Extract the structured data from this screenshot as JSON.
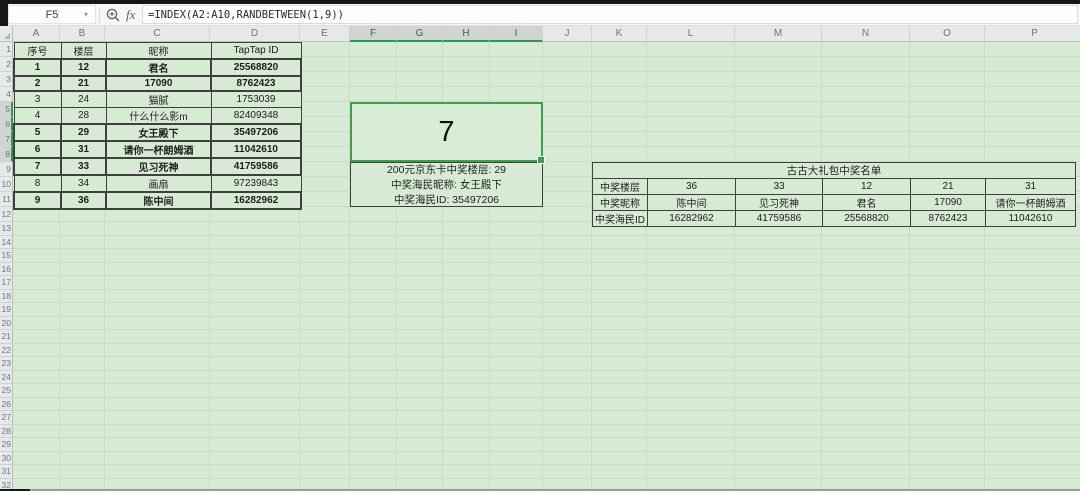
{
  "app": {
    "formula_bar": {
      "name_box": "F5",
      "fx_label": "fx",
      "formula": "=INDEX(A2:A10,RANDBETWEEN(1,9))"
    }
  },
  "grid": {
    "column_letters": [
      "A",
      "B",
      "C",
      "D",
      "E",
      "F",
      "G",
      "H",
      "I",
      "J",
      "K",
      "L",
      "M",
      "N",
      "O",
      "P"
    ],
    "selected_columns": [
      "F",
      "G",
      "H",
      "I"
    ],
    "row_count": 32,
    "selected_rows": [
      5,
      6,
      7,
      8
    ]
  },
  "left_table": {
    "headers": [
      "序号",
      "楼层",
      "昵称",
      "TapTap ID"
    ],
    "rows": [
      {
        "cells": [
          "1",
          "12",
          "君名",
          "25568820"
        ],
        "bold": true
      },
      {
        "cells": [
          "2",
          "21",
          "17090",
          "8762423"
        ],
        "bold": true
      },
      {
        "cells": [
          "3",
          "24",
          "猫腻",
          "1753039"
        ],
        "bold": false
      },
      {
        "cells": [
          "4",
          "28",
          "什么什么影m",
          "82409348"
        ],
        "bold": false
      },
      {
        "cells": [
          "5",
          "29",
          "女王殿下",
          "35497206"
        ],
        "bold": true
      },
      {
        "cells": [
          "6",
          "31",
          "请你一杯朗姆酒",
          "11042610"
        ],
        "bold": true
      },
      {
        "cells": [
          "7",
          "33",
          "见习死神",
          "41759586"
        ],
        "bold": true
      },
      {
        "cells": [
          "8",
          "34",
          "画扇",
          "97239843"
        ],
        "bold": false
      },
      {
        "cells": [
          "9",
          "36",
          "陈中间",
          "16282962"
        ],
        "bold": true
      }
    ]
  },
  "draw_result": {
    "value": "7"
  },
  "prize_info": {
    "lines": [
      "200元京东卡中奖楼层: 29",
      "中奖海民昵称: 女王殿下",
      "中奖海民ID: 35497206"
    ]
  },
  "right_table": {
    "title": "古古大礼包中奖名单",
    "row_labels": [
      "中奖楼层",
      "中奖昵称",
      "中奖海民ID"
    ],
    "winners": [
      {
        "floor": "36",
        "nickname": "陈中间",
        "id": "16282962"
      },
      {
        "floor": "33",
        "nickname": "见习死神",
        "id": "41759586"
      },
      {
        "floor": "12",
        "nickname": "君名",
        "id": "25568820"
      },
      {
        "floor": "21",
        "nickname": "17090",
        "id": "8762423"
      },
      {
        "floor": "31",
        "nickname": "请你一杯朗姆酒",
        "id": "11042610"
      }
    ]
  },
  "colors": {
    "sheet_bg": "#d7ebd4",
    "selection_green": "#3e9e50",
    "selected_header_text": "#217346",
    "grid_line": "#c7ddc4"
  }
}
